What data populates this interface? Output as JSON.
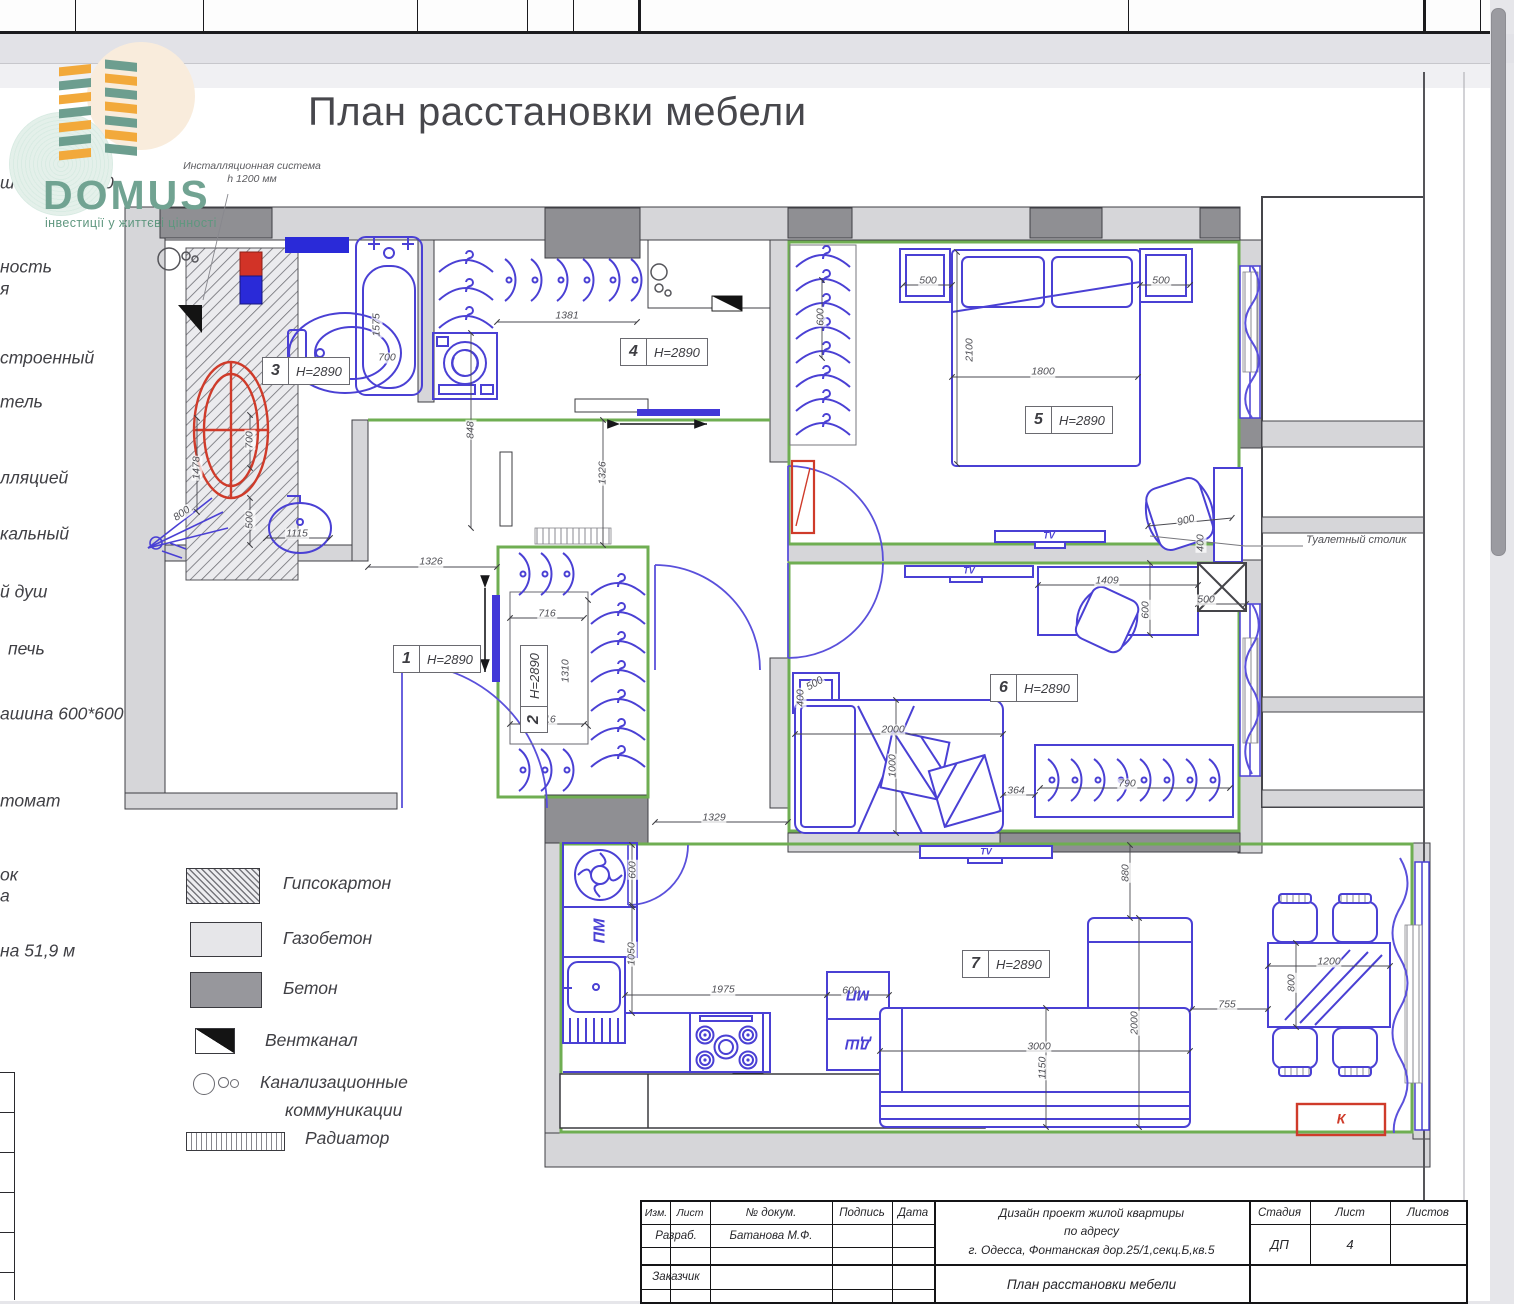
{
  "title": "План расстановки мебели",
  "logo": {
    "name": "DOMUS",
    "tagline": "інвестиції у життєві цінності"
  },
  "install_note": {
    "line1": "Инсталляционная система",
    "line2": "h 1200 мм"
  },
  "toilet_table_label": "Туалетный столик",
  "left_labels": [
    {
      "t": "шина 450*600",
      "x": 0,
      "y": 183
    },
    {
      "t": "ность",
      "x": 0,
      "y": 267
    },
    {
      "t": "я",
      "x": 0,
      "y": 289
    },
    {
      "t": "строенный",
      "x": 0,
      "y": 358
    },
    {
      "t": "тель",
      "x": 0,
      "y": 402
    },
    {
      "t": "лляцией",
      "x": 0,
      "y": 478
    },
    {
      "t": "кальный",
      "x": 0,
      "y": 534
    },
    {
      "t": "й душ",
      "x": 0,
      "y": 592
    },
    {
      "t": "печь",
      "x": 8,
      "y": 649
    },
    {
      "t": "ашина 600*600",
      "x": 0,
      "y": 714
    },
    {
      "t": "томат",
      "x": 0,
      "y": 801
    },
    {
      "t": "ок",
      "x": 0,
      "y": 875
    },
    {
      "t": "а",
      "x": 0,
      "y": 896
    },
    {
      "t": "на 51,9 м",
      "x": 0,
      "y": 951
    }
  ],
  "legend": {
    "items": [
      {
        "label": "Гипсокартон"
      },
      {
        "label": "Газобетон"
      },
      {
        "label": "Бетон"
      },
      {
        "label": "Вентканал"
      },
      {
        "label": "Канализационные",
        "label2": "коммуникации"
      },
      {
        "label": "Радиатор"
      }
    ]
  },
  "rooms": [
    {
      "num": "1",
      "h": "H=2890"
    },
    {
      "num": "2",
      "h": "H=2890"
    },
    {
      "num": "3",
      "h": "H=2890"
    },
    {
      "num": "4",
      "h": "H=2890"
    },
    {
      "num": "5",
      "h": "H=2890"
    },
    {
      "num": "6",
      "h": "H=2890"
    },
    {
      "num": "7",
      "h": "H=2890"
    }
  ],
  "dims": [
    {
      "t": "1575",
      "x": 377,
      "y": 325,
      "r": -90
    },
    {
      "t": "700",
      "x": 387,
      "y": 358
    },
    {
      "t": "1381",
      "x": 567,
      "y": 316
    },
    {
      "t": "848",
      "x": 471,
      "y": 430,
      "r": -90
    },
    {
      "t": "700",
      "x": 250,
      "y": 440,
      "r": -90
    },
    {
      "t": "1478",
      "x": 197,
      "y": 468,
      "r": -90
    },
    {
      "t": "800",
      "x": 182,
      "y": 514,
      "r": -35
    },
    {
      "t": "500",
      "x": 250,
      "y": 520,
      "r": -90
    },
    {
      "t": "1115",
      "x": 297,
      "y": 534
    },
    {
      "t": "1326",
      "x": 431,
      "y": 562
    },
    {
      "t": "1326",
      "x": 603,
      "y": 473,
      "r": -90
    },
    {
      "t": "716",
      "x": 547,
      "y": 614
    },
    {
      "t": "1310",
      "x": 566,
      "y": 671,
      "r": -90
    },
    {
      "t": "716",
      "x": 547,
      "y": 720
    },
    {
      "t": "1329",
      "x": 714,
      "y": 818
    },
    {
      "t": "500",
      "x": 928,
      "y": 281
    },
    {
      "t": "500",
      "x": 1161,
      "y": 281
    },
    {
      "t": "2100",
      "x": 970,
      "y": 350,
      "r": -90
    },
    {
      "t": "1800",
      "x": 1043,
      "y": 372
    },
    {
      "t": "600",
      "x": 821,
      "y": 317,
      "r": -90
    },
    {
      "t": "900",
      "x": 1186,
      "y": 521,
      "r": -15
    },
    {
      "t": "400",
      "x": 1201,
      "y": 543,
      "r": -90
    },
    {
      "t": "1409",
      "x": 1107,
      "y": 581
    },
    {
      "t": "600",
      "x": 1146,
      "y": 610,
      "r": -90
    },
    {
      "t": "500",
      "x": 1206,
      "y": 600
    },
    {
      "t": "2000",
      "x": 893,
      "y": 730
    },
    {
      "t": "1000",
      "x": 893,
      "y": 766,
      "r": -90
    },
    {
      "t": "364",
      "x": 1016,
      "y": 791
    },
    {
      "t": "790",
      "x": 1127,
      "y": 784
    },
    {
      "t": "500",
      "x": 815,
      "y": 684,
      "r": -30
    },
    {
      "t": "400",
      "x": 801,
      "y": 698,
      "r": -90
    },
    {
      "t": "600",
      "x": 633,
      "y": 870,
      "r": -90
    },
    {
      "t": "1050",
      "x": 632,
      "y": 954,
      "r": -90
    },
    {
      "t": "1975",
      "x": 723,
      "y": 990
    },
    {
      "t": "600",
      "x": 851,
      "y": 991
    },
    {
      "t": "880",
      "x": 1126,
      "y": 873,
      "r": -90
    },
    {
      "t": "2000",
      "x": 1135,
      "y": 1023,
      "r": -90
    },
    {
      "t": "3000",
      "x": 1039,
      "y": 1047
    },
    {
      "t": "1150",
      "x": 1043,
      "y": 1068,
      "r": -90
    },
    {
      "t": "755",
      "x": 1227,
      "y": 1005
    },
    {
      "t": "1200",
      "x": 1329,
      "y": 962
    },
    {
      "t": "800",
      "x": 1292,
      "y": 983,
      "r": -90
    },
    {
      "t": "TV",
      "x": 1049,
      "y": 536,
      "c": "b",
      "s": 9
    },
    {
      "t": "TV",
      "x": 969,
      "y": 571,
      "c": "b",
      "s": 9
    },
    {
      "t": "TV",
      "x": 986,
      "y": 852,
      "c": "b",
      "s": 9
    },
    {
      "t": "ПМ",
      "x": 600,
      "y": 931,
      "r": -90,
      "c": "b",
      "s": 16
    },
    {
      "t": "МП",
      "x": 858,
      "y": 995,
      "r": 180,
      "c": "b",
      "s": 15
    },
    {
      "t": "ДШ",
      "x": 858,
      "y": 1044,
      "r": 180,
      "c": "b",
      "s": 15
    },
    {
      "t": "К",
      "x": 1341,
      "y": 1119,
      "c": "r",
      "s": 14
    }
  ],
  "note": {
    "head": "Примечание:",
    "line1": " все размеры указаны в мм",
    "line2": "За отм. 0.000 на данном листе принята отметка чистого пола",
    "line3": "Все размеры мебели без учета черновых и чистовых отделочных"
  },
  "titleblock": {
    "izm": "Изм.",
    "list": "Лист",
    "doc": "№ докум.",
    "sign": "Подпись",
    "date": "Дата",
    "razrab": "Разраб.",
    "razrab_val": "Батанова М.Ф.",
    "zakaz": "Заказчик",
    "project_line1": "Дизайн проект жилой квартиры",
    "project_line2": "по адресу",
    "project_line3": "г. Одесса, Фонтанская дор.25/1,секц.Б,кв.5",
    "stage": "Стадия",
    "sheet": "Лист",
    "sheets": "Листов",
    "stage_val": "ДП",
    "sheet_val": "4",
    "doc_title": "План расстановки мебели"
  }
}
